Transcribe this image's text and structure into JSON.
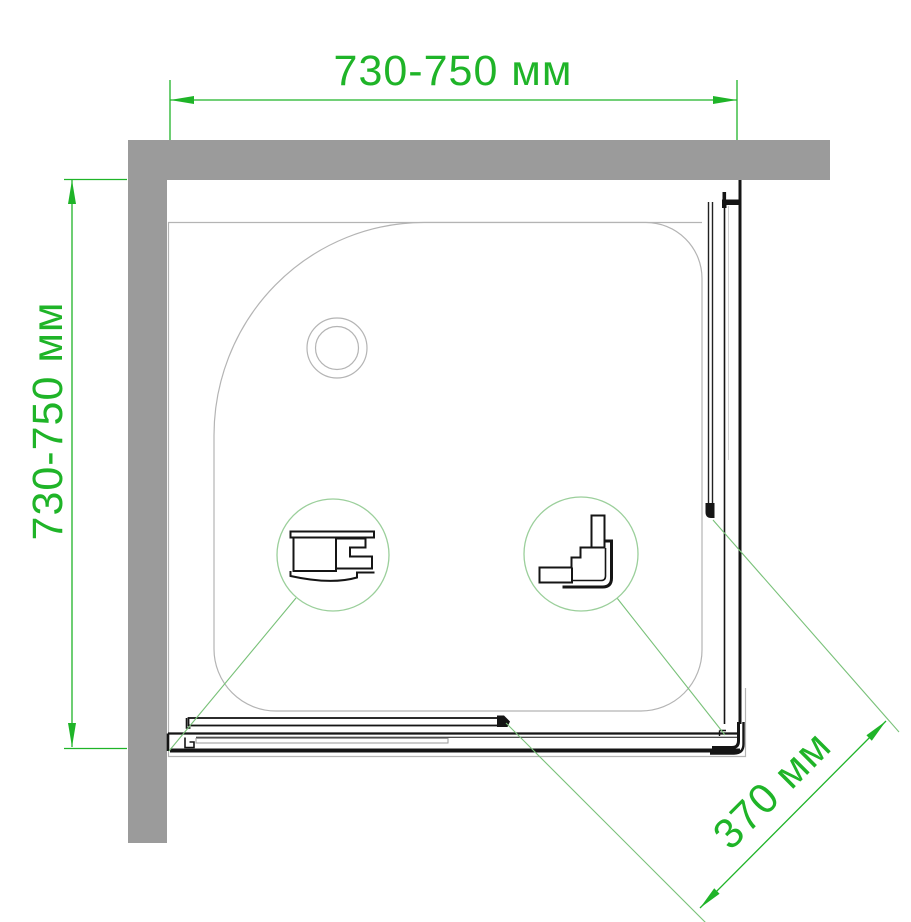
{
  "dimensions": {
    "width_top": "730-750 мм",
    "depth_left": "730-750 мм",
    "door_opening_diagonal": "370 мм"
  },
  "colors": {
    "wall": "#9b9b9b",
    "tray_line": "#b4b4b4",
    "frame": "#151515",
    "glass_line": "#222222",
    "glass_slot": "#9a9a9a",
    "dim_green": "#1fb428",
    "leader_green": "#79c179",
    "circle_green": "#9bcf9b",
    "background": "#ffffff"
  }
}
